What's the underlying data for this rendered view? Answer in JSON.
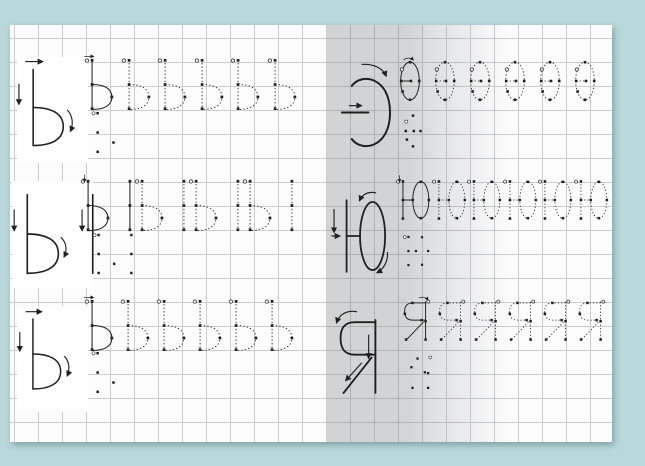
{
  "document": {
    "kind": "cursive handwriting tracing worksheet",
    "language": "Russian",
    "letters_practiced": [
      "Ь",
      "Ы",
      "Э",
      "Ю",
      "Я"
    ],
    "spread": {
      "left_page": {
        "rows": [
          {
            "model_letter": "Ь",
            "trace_count": 6,
            "trace_letters": [
              "Ь",
              "Ь",
              "Ь",
              "Ь",
              "Ь",
              "Ь"
            ],
            "has_guide_dots": true,
            "model_on_white_card": true
          },
          {
            "model_letter": "Ы",
            "trace_count": 4,
            "trace_letters": [
              "Ы",
              "Ы",
              "Ы",
              "Ы"
            ],
            "has_guide_dots": true,
            "model_on_white_card": true
          },
          {
            "model_letter": "Ь",
            "trace_count": 6,
            "trace_letters": [
              "Ь",
              "Ь",
              "Ь",
              "Ь",
              "Ь",
              "Ь"
            ],
            "has_guide_dots": true,
            "model_on_white_card": true
          }
        ]
      },
      "right_page": {
        "rows": [
          {
            "model_letter": "Э",
            "trace_count": 6,
            "trace_letters": [
              "Э",
              "Э",
              "Э",
              "Э",
              "Э",
              "Э"
            ],
            "has_guide_dots": true,
            "model_on_white_card": false
          },
          {
            "model_letter": "Ю",
            "trace_count": 6,
            "trace_letters": [
              "Ю",
              "Ю",
              "Ю",
              "Ю",
              "Ю",
              "Ю"
            ],
            "has_guide_dots": true,
            "model_on_white_card": false
          },
          {
            "model_letter": "Я",
            "trace_count": 6,
            "trace_letters": [
              "Я",
              "Я",
              "Я",
              "Я",
              "Я",
              "Я"
            ],
            "has_guide_dots": true,
            "model_on_white_card": false
          }
        ]
      }
    }
  },
  "colors": {
    "background": "#b8d8db",
    "page": "#fcfcfd",
    "grid_line": "#c9cdcf",
    "ink": "#202020",
    "spine_shadow": "#9aa0a2",
    "card": "#ffffff"
  }
}
